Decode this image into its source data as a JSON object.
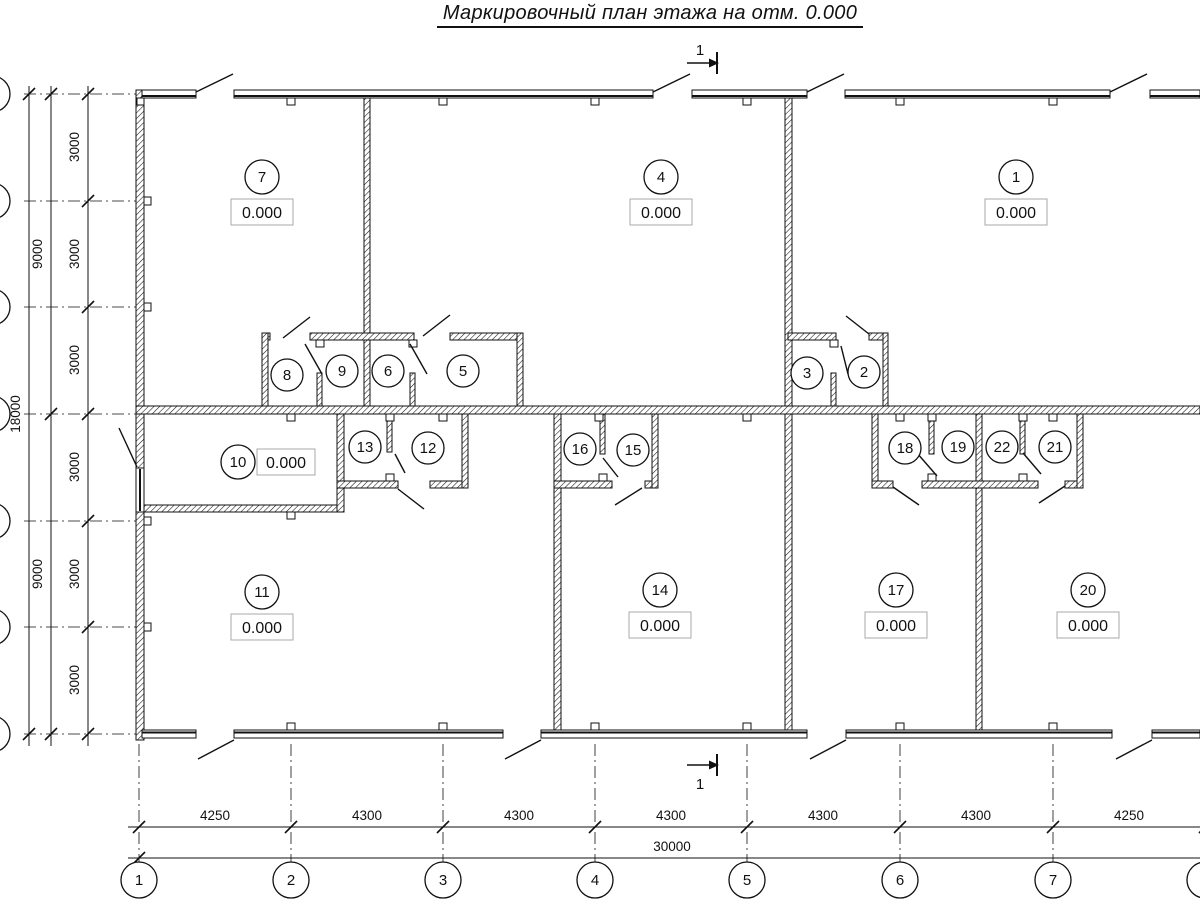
{
  "title": "Маркировочный план этажа на отм. 0.000",
  "section": {
    "label": "1"
  },
  "rooms": {
    "r7": {
      "num": "7",
      "elev": "0.000"
    },
    "r4": {
      "num": "4",
      "elev": "0.000"
    },
    "r1": {
      "num": "1",
      "elev": "0.000"
    },
    "r8": {
      "num": "8"
    },
    "r9": {
      "num": "9"
    },
    "r6": {
      "num": "6"
    },
    "r5": {
      "num": "5"
    },
    "r3": {
      "num": "3"
    },
    "r2": {
      "num": "2"
    },
    "r10": {
      "num": "10",
      "elev": "0.000"
    },
    "r13": {
      "num": "13"
    },
    "r12": {
      "num": "12"
    },
    "r16": {
      "num": "16"
    },
    "r15": {
      "num": "15"
    },
    "r18": {
      "num": "18"
    },
    "r19": {
      "num": "19"
    },
    "r22": {
      "num": "22"
    },
    "r21": {
      "num": "21"
    },
    "r11": {
      "num": "11",
      "elev": "0.000"
    },
    "r14": {
      "num": "14",
      "elev": "0.000"
    },
    "r17": {
      "num": "17",
      "elev": "0.000"
    },
    "r20": {
      "num": "20",
      "elev": "0.000"
    }
  },
  "dims": {
    "bottom": {
      "d1": "4250",
      "d2": "4300",
      "d3": "4300",
      "d4": "4300",
      "d5": "4300",
      "d6": "4300",
      "d7": "4250",
      "total": "30000"
    },
    "left": {
      "s1": "3000",
      "s2": "3000",
      "s3": "3000",
      "s4": "3000",
      "s5": "3000",
      "s6": "3000",
      "g1": "9000",
      "g2": "9000",
      "total": "18000"
    }
  },
  "axes": {
    "a1": "1",
    "a2": "2",
    "a3": "3",
    "a4": "4",
    "a5": "5",
    "a6": "6",
    "a7": "7"
  }
}
